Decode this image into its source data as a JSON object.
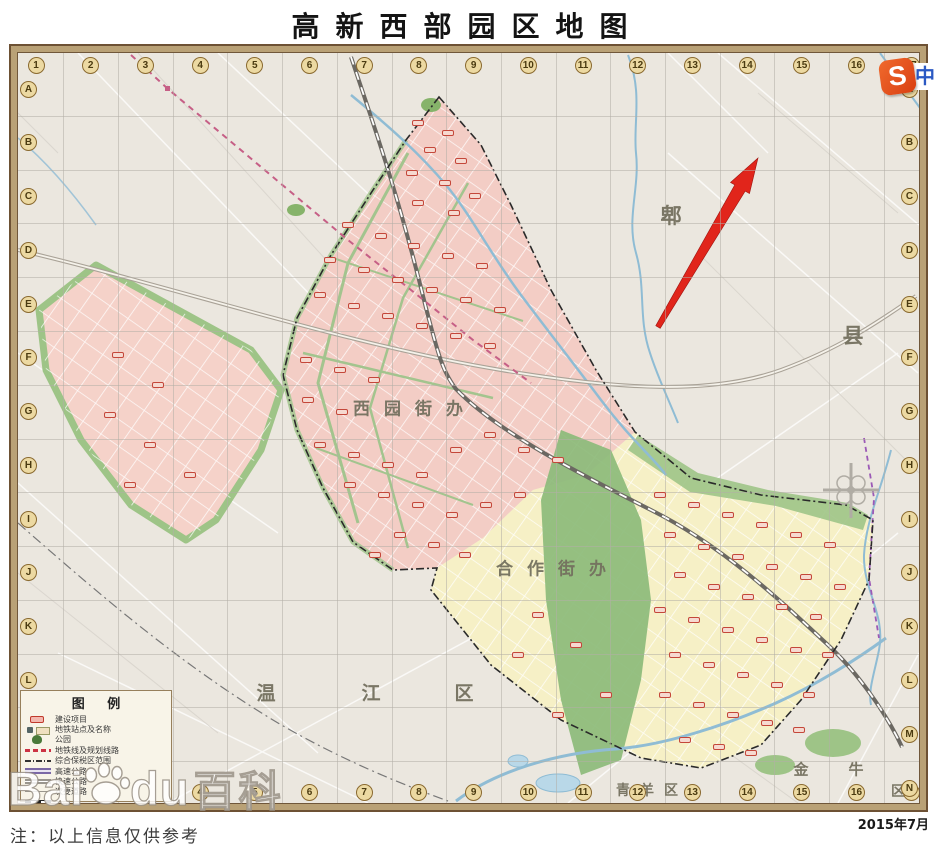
{
  "title": "高新西部园区地图",
  "footer": {
    "note": "注：以上信息仅供参考",
    "date": "2015年7月"
  },
  "watermark": {
    "part1": "Bai",
    "part2": "du",
    "part3": "百科",
    "paw_icon": "baidu-paw-icon"
  },
  "logo": {
    "letter": "S",
    "cn": "中"
  },
  "grid": {
    "columns": [
      "1",
      "2",
      "3",
      "4",
      "5",
      "6",
      "7",
      "8",
      "9",
      "10",
      "11",
      "12",
      "13",
      "14",
      "15",
      "16",
      "17"
    ],
    "rows": [
      "A",
      "B",
      "C",
      "D",
      "E",
      "F",
      "G",
      "H",
      "I",
      "J",
      "K",
      "L",
      "M",
      "N"
    ]
  },
  "legend": {
    "title": "图 例",
    "items": [
      {
        "swatch": "project",
        "label": "建设项目"
      },
      {
        "swatch": "metro-station",
        "label": "地铁站点及名称"
      },
      {
        "swatch": "park",
        "label": "公园"
      },
      {
        "swatch": "metro-line",
        "label": "地铁线及规划线路"
      },
      {
        "swatch": "bonded",
        "label": "综合保税区范围"
      },
      {
        "swatch": "expwy",
        "label": "高速公路"
      },
      {
        "swatch": "fastwy",
        "label": "快速公路"
      },
      {
        "swatch": "minor",
        "label": "次要道路"
      },
      {
        "swatch": "rail",
        "label": ""
      },
      {
        "swatch": "dash2",
        "label": ""
      }
    ]
  },
  "map": {
    "labels": [
      {
        "text": "郫",
        "x": 653,
        "y": 162,
        "size": 21,
        "ls": 0
      },
      {
        "text": "县",
        "x": 835,
        "y": 282,
        "size": 21,
        "ls": 0
      },
      {
        "text": "西园街办",
        "x": 397,
        "y": 354,
        "size": 17,
        "ls": 14
      },
      {
        "text": "合作街办",
        "x": 540,
        "y": 514,
        "size": 17,
        "ls": 14
      },
      {
        "text": "温",
        "x": 248,
        "y": 639,
        "size": 19,
        "ls": 0
      },
      {
        "text": "江",
        "x": 353,
        "y": 639,
        "size": 19,
        "ls": 0
      },
      {
        "text": "区",
        "x": 446,
        "y": 639,
        "size": 19,
        "ls": 0
      },
      {
        "text": "青羊区",
        "x": 634,
        "y": 737,
        "size": 14,
        "ls": 10
      },
      {
        "text": "金",
        "x": 783,
        "y": 716,
        "size": 15,
        "ls": 0
      },
      {
        "text": "牛",
        "x": 838,
        "y": 716,
        "size": 15,
        "ls": 0
      },
      {
        "text": "区",
        "x": 880,
        "y": 738,
        "size": 14,
        "ls": 0
      }
    ],
    "markers": [
      [
        400,
        70
      ],
      [
        430,
        80
      ],
      [
        412,
        97
      ],
      [
        443,
        108
      ],
      [
        394,
        120
      ],
      [
        427,
        130
      ],
      [
        457,
        143
      ],
      [
        400,
        150
      ],
      [
        436,
        160
      ],
      [
        330,
        172
      ],
      [
        363,
        183
      ],
      [
        396,
        193
      ],
      [
        430,
        203
      ],
      [
        464,
        213
      ],
      [
        312,
        207
      ],
      [
        346,
        217
      ],
      [
        380,
        227
      ],
      [
        414,
        237
      ],
      [
        448,
        247
      ],
      [
        482,
        257
      ],
      [
        302,
        242
      ],
      [
        336,
        253
      ],
      [
        370,
        263
      ],
      [
        404,
        273
      ],
      [
        438,
        283
      ],
      [
        472,
        293
      ],
      [
        288,
        307
      ],
      [
        322,
        317
      ],
      [
        356,
        327
      ],
      [
        290,
        347
      ],
      [
        324,
        359
      ],
      [
        302,
        392
      ],
      [
        336,
        402
      ],
      [
        370,
        412
      ],
      [
        404,
        422
      ],
      [
        438,
        397
      ],
      [
        472,
        382
      ],
      [
        506,
        397
      ],
      [
        540,
        407
      ],
      [
        332,
        432
      ],
      [
        366,
        442
      ],
      [
        400,
        452
      ],
      [
        434,
        462
      ],
      [
        468,
        452
      ],
      [
        502,
        442
      ],
      [
        382,
        482
      ],
      [
        416,
        492
      ],
      [
        357,
        502
      ],
      [
        447,
        502
      ],
      [
        100,
        302
      ],
      [
        140,
        332
      ],
      [
        92,
        362
      ],
      [
        132,
        392
      ],
      [
        172,
        422
      ],
      [
        112,
        432
      ],
      [
        642,
        442
      ],
      [
        676,
        452
      ],
      [
        710,
        462
      ],
      [
        744,
        472
      ],
      [
        778,
        482
      ],
      [
        812,
        492
      ],
      [
        652,
        482
      ],
      [
        686,
        494
      ],
      [
        720,
        504
      ],
      [
        754,
        514
      ],
      [
        788,
        524
      ],
      [
        822,
        534
      ],
      [
        662,
        522
      ],
      [
        696,
        534
      ],
      [
        730,
        544
      ],
      [
        764,
        554
      ],
      [
        798,
        564
      ],
      [
        642,
        557
      ],
      [
        676,
        567
      ],
      [
        710,
        577
      ],
      [
        744,
        587
      ],
      [
        778,
        597
      ],
      [
        810,
        602
      ],
      [
        657,
        602
      ],
      [
        691,
        612
      ],
      [
        725,
        622
      ],
      [
        759,
        632
      ],
      [
        791,
        642
      ],
      [
        647,
        642
      ],
      [
        681,
        652
      ],
      [
        715,
        662
      ],
      [
        749,
        670
      ],
      [
        781,
        677
      ],
      [
        667,
        687
      ],
      [
        701,
        694
      ],
      [
        733,
        700
      ],
      [
        520,
        562
      ],
      [
        558,
        592
      ],
      [
        500,
        602
      ],
      [
        588,
        642
      ],
      [
        540,
        662
      ]
    ]
  },
  "colors": {
    "arrow_red": "#e1251b",
    "district_pink": "#f3cdc5",
    "district_yellow": "#f6f0c6",
    "green": "#8cbb7a",
    "river_blue": "#8fbcd4",
    "frame_tan": "#b9a176",
    "coord_badge": "#ecd9a2",
    "metro_dash_pink": "#c65f86",
    "expressway_purple": "#9b59b6",
    "logo_orange": "#e85a24",
    "logo_blue": "#2b59c3"
  }
}
